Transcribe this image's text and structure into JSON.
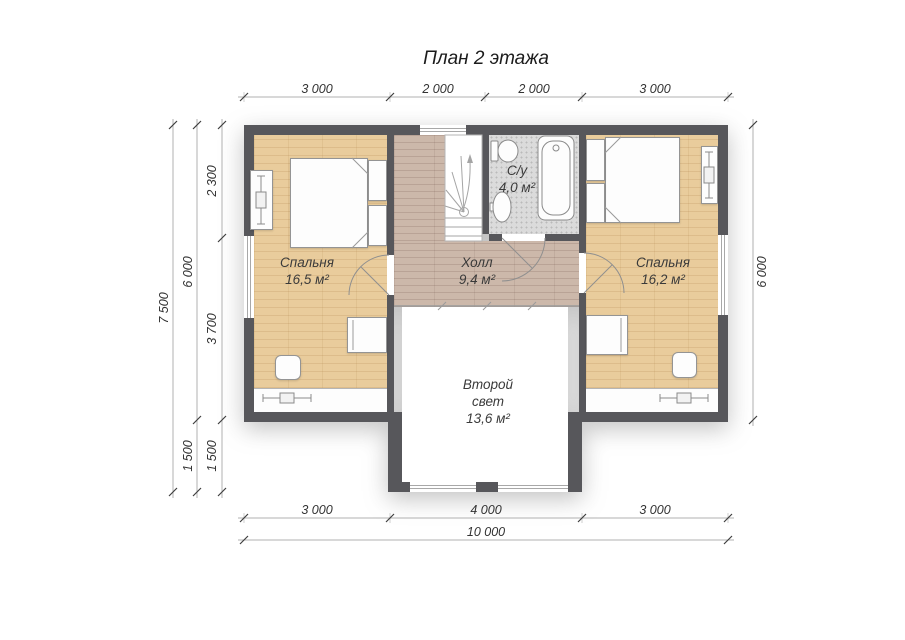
{
  "title": "План 2 этажа",
  "rooms": {
    "bedroom_left": {
      "name": "Спальня",
      "area": "16,5 м²"
    },
    "hall": {
      "name": "Холл",
      "area": "9,4 м²"
    },
    "bathroom": {
      "name": "С/у",
      "area": "4,0 м²"
    },
    "bedroom_right": {
      "name": "Спальня",
      "area": "16,2 м²"
    },
    "second_light": {
      "name": "Второй свет",
      "area": "13,6 м²"
    }
  },
  "dimensions": {
    "top": [
      "3 000",
      "2 000",
      "2 000",
      "3 000"
    ],
    "left_inner": [
      "2 300",
      "3 700",
      "1 500"
    ],
    "left_middle": [
      "6 000",
      "1 500"
    ],
    "left_outer": "7 500",
    "right": "6 000",
    "bottom_inner": [
      "3 000",
      "4 000",
      "3 000"
    ],
    "bottom_outer": "10 000"
  },
  "colors": {
    "wall": "#57575b",
    "wood_floor": "#e9cc9c",
    "hall_floor": "#ccb8aa",
    "tile_floor": "#dbdbdb",
    "dimension_line": "#b0b0b0"
  }
}
